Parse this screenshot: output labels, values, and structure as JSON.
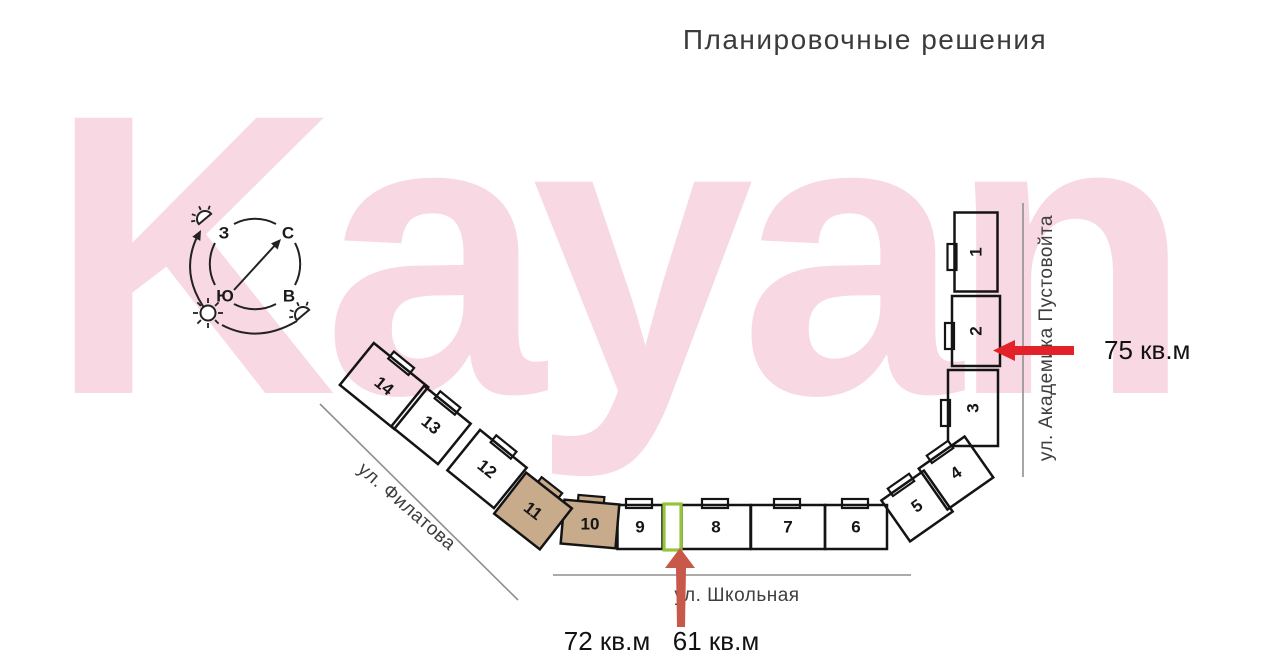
{
  "title": "Планировочные решения",
  "watermark": "Kayan",
  "compass": {
    "north": "С",
    "south": "Ю",
    "west": "З",
    "east": "В"
  },
  "streets": [
    {
      "id": "filatova",
      "name": "ул. Филатова"
    },
    {
      "id": "shkolnaya",
      "name": "ул. Школьная"
    },
    {
      "id": "pustovoyta",
      "name": "ул. Академика Пустовойта"
    }
  ],
  "plan": {
    "sections": [
      {
        "label": "1",
        "highlighted": false
      },
      {
        "label": "2",
        "highlighted": false
      },
      {
        "label": "3",
        "highlighted": false
      },
      {
        "label": "4",
        "highlighted": false
      },
      {
        "label": "5",
        "highlighted": false
      },
      {
        "label": "6",
        "highlighted": false
      },
      {
        "label": "7",
        "highlighted": false
      },
      {
        "label": "8",
        "highlighted": false
      },
      {
        "label": "9",
        "highlighted": false
      },
      {
        "label": "10",
        "highlighted": true
      },
      {
        "label": "11",
        "highlighted": true
      },
      {
        "label": "12",
        "highlighted": false
      },
      {
        "label": "13",
        "highlighted": false
      },
      {
        "label": "14",
        "highlighted": false
      }
    ],
    "selected_unit_outline": true
  },
  "annotations": [
    {
      "id": "area-75",
      "label": "75 кв.м",
      "arrow": "left"
    },
    {
      "id": "area-72",
      "label": "72 кв.м",
      "arrow": "none"
    },
    {
      "id": "area-61",
      "label": "61 кв.м",
      "arrow": "up"
    }
  ],
  "colors": {
    "highlight_fill": "#c7ab8b",
    "green_outline": "#96c33c",
    "arrow_red": "#e32128",
    "arrow_salmon": "#c8584a",
    "watermark_pink": "#f8d8e2",
    "outline_black": "#141414",
    "street_gray": "#8f8f8f"
  }
}
